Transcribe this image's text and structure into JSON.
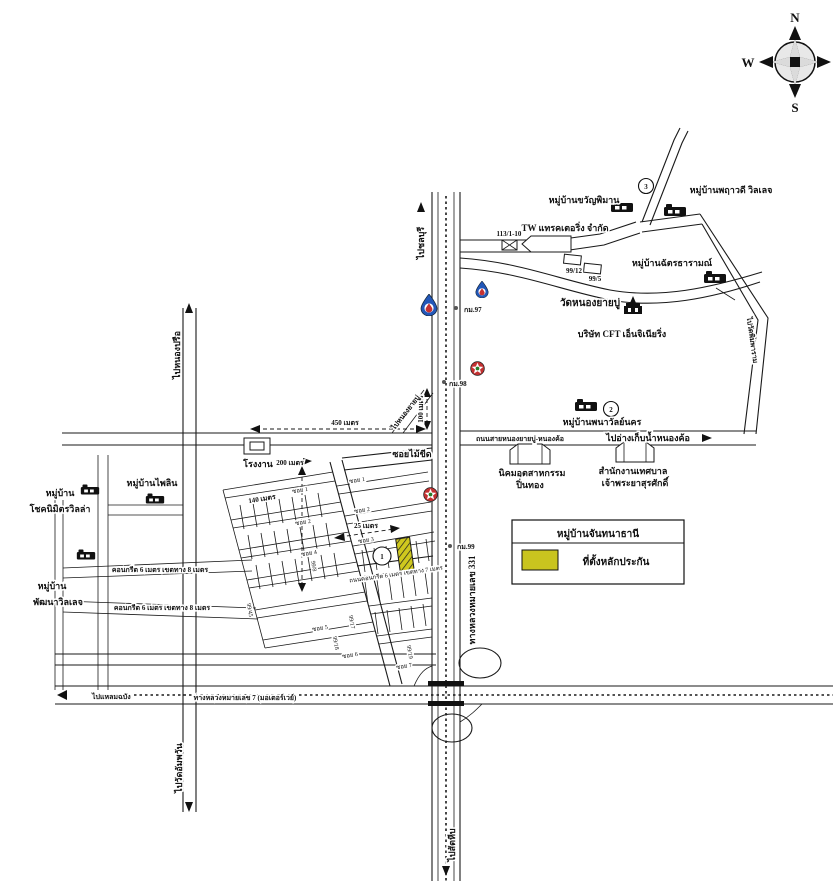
{
  "compass": {
    "n": "N",
    "e": "E",
    "s": "S",
    "w": "W"
  },
  "legend": {
    "title": "หมู่บ้านจันทนาธานี",
    "site_label": "ที่ตั้งหลักประกัน",
    "site_color": "#c9c41f"
  },
  "directions": {
    "chonburi": "ไปชลบุรี",
    "sattahip": "ไปสัตหีบ",
    "laem_chabang": "ไปแหลมฉบัง",
    "nong_kho": "ไปอ่างเก็บน้ำหนองค้อ",
    "nong_prue": "ไปหนองปรือ",
    "wat_ampawan": "ไปวัดอัมพวัน",
    "nong_yai_bu": "ไปหนองยายบู่",
    "wat_phimpharam": "ไปวัดพิมพาราม"
  },
  "roads": {
    "motorway": "ทางหลวงหมายเลข 7 (มอเตอร์เวย์)",
    "highway331": "ทางหลวงหมายเลข 331",
    "nongkho_road": "ถนนสายหนองยายบู่-หนองค้อ",
    "soi_mai_kheed": "ซอยไม้ขีด",
    "concrete8a": "คอนกรีต 6 เมตร เขตทาง 8 เมตร",
    "concrete8b": "คอนกรีต 6 เมตร เขตทาง 8 เมตร",
    "concrete7": "ถนนคอนกรีต 6 เมตร เขตทาง 7 เมตร",
    "soi1": "ซอย 1",
    "soi2": "ซอย 2",
    "soi3": "ซอย 3",
    "soi4": "ซอย 4",
    "soi5": "ซอย 5",
    "soi6": "ซอย 6",
    "soi7": "ซอย 7"
  },
  "places": {
    "tw_factory": "TW แทรคเตอริ่ง จำกัด",
    "village_khwan_phiman": "หมู่บ้านขวัญพิมาน",
    "village_pharuethawadee": "หมู่บ้านพฤาวดี วิลเลจ",
    "village_chat_tharam": "หมู่บ้านฉัตรธารามณ์",
    "wat_nong_yai_bu": "วัดหนองยายบู่",
    "cft": "บริษัท CFT เอ็นจิเนียริ่ง",
    "village_phanawan": "หมู่บ้านพนาวัลย์นคร",
    "municipality1": "สำนักงานเทศบาล",
    "municipality2": "เจ้าพระยาสุรศักดิ์",
    "pinthong1": "นิคมอุตสาหกรรม",
    "pinthong2": "ปิ่นทอง",
    "village_pailin": "หมู่บ้านไพลิน",
    "village_choknimit1": "หมู่บ้าน",
    "village_choknimit2": "โชคนิมิตรวิลล่า",
    "village_pattana1": "หมู่บ้าน",
    "village_pattana2": "พัฒนาวิลเลจ",
    "factory": "โรงงาน"
  },
  "house_numbers": {
    "n113": "113/1-10",
    "n9912": "99/12",
    "n995": "99/5",
    "n9945": "99/45",
    "n998": "99/8",
    "n9917": "99/17",
    "n9918": "99/18",
    "n9919": "99/19"
  },
  "km_markers": {
    "km97": "กม.97",
    "km98": "กม.98",
    "km99": "กม.99"
  },
  "distances": {
    "d450": "450 เมตร",
    "d100": "100 เมตร",
    "d200": "200 เมตร",
    "d140": "140 เมตร",
    "d25": "25 เมตร"
  },
  "badges": {
    "b1": "1",
    "b2": "2",
    "b3": "3"
  },
  "colors": {
    "fuel_blue": "#2257b8",
    "marker_red": "#c43131",
    "site": "#c9c41f"
  }
}
